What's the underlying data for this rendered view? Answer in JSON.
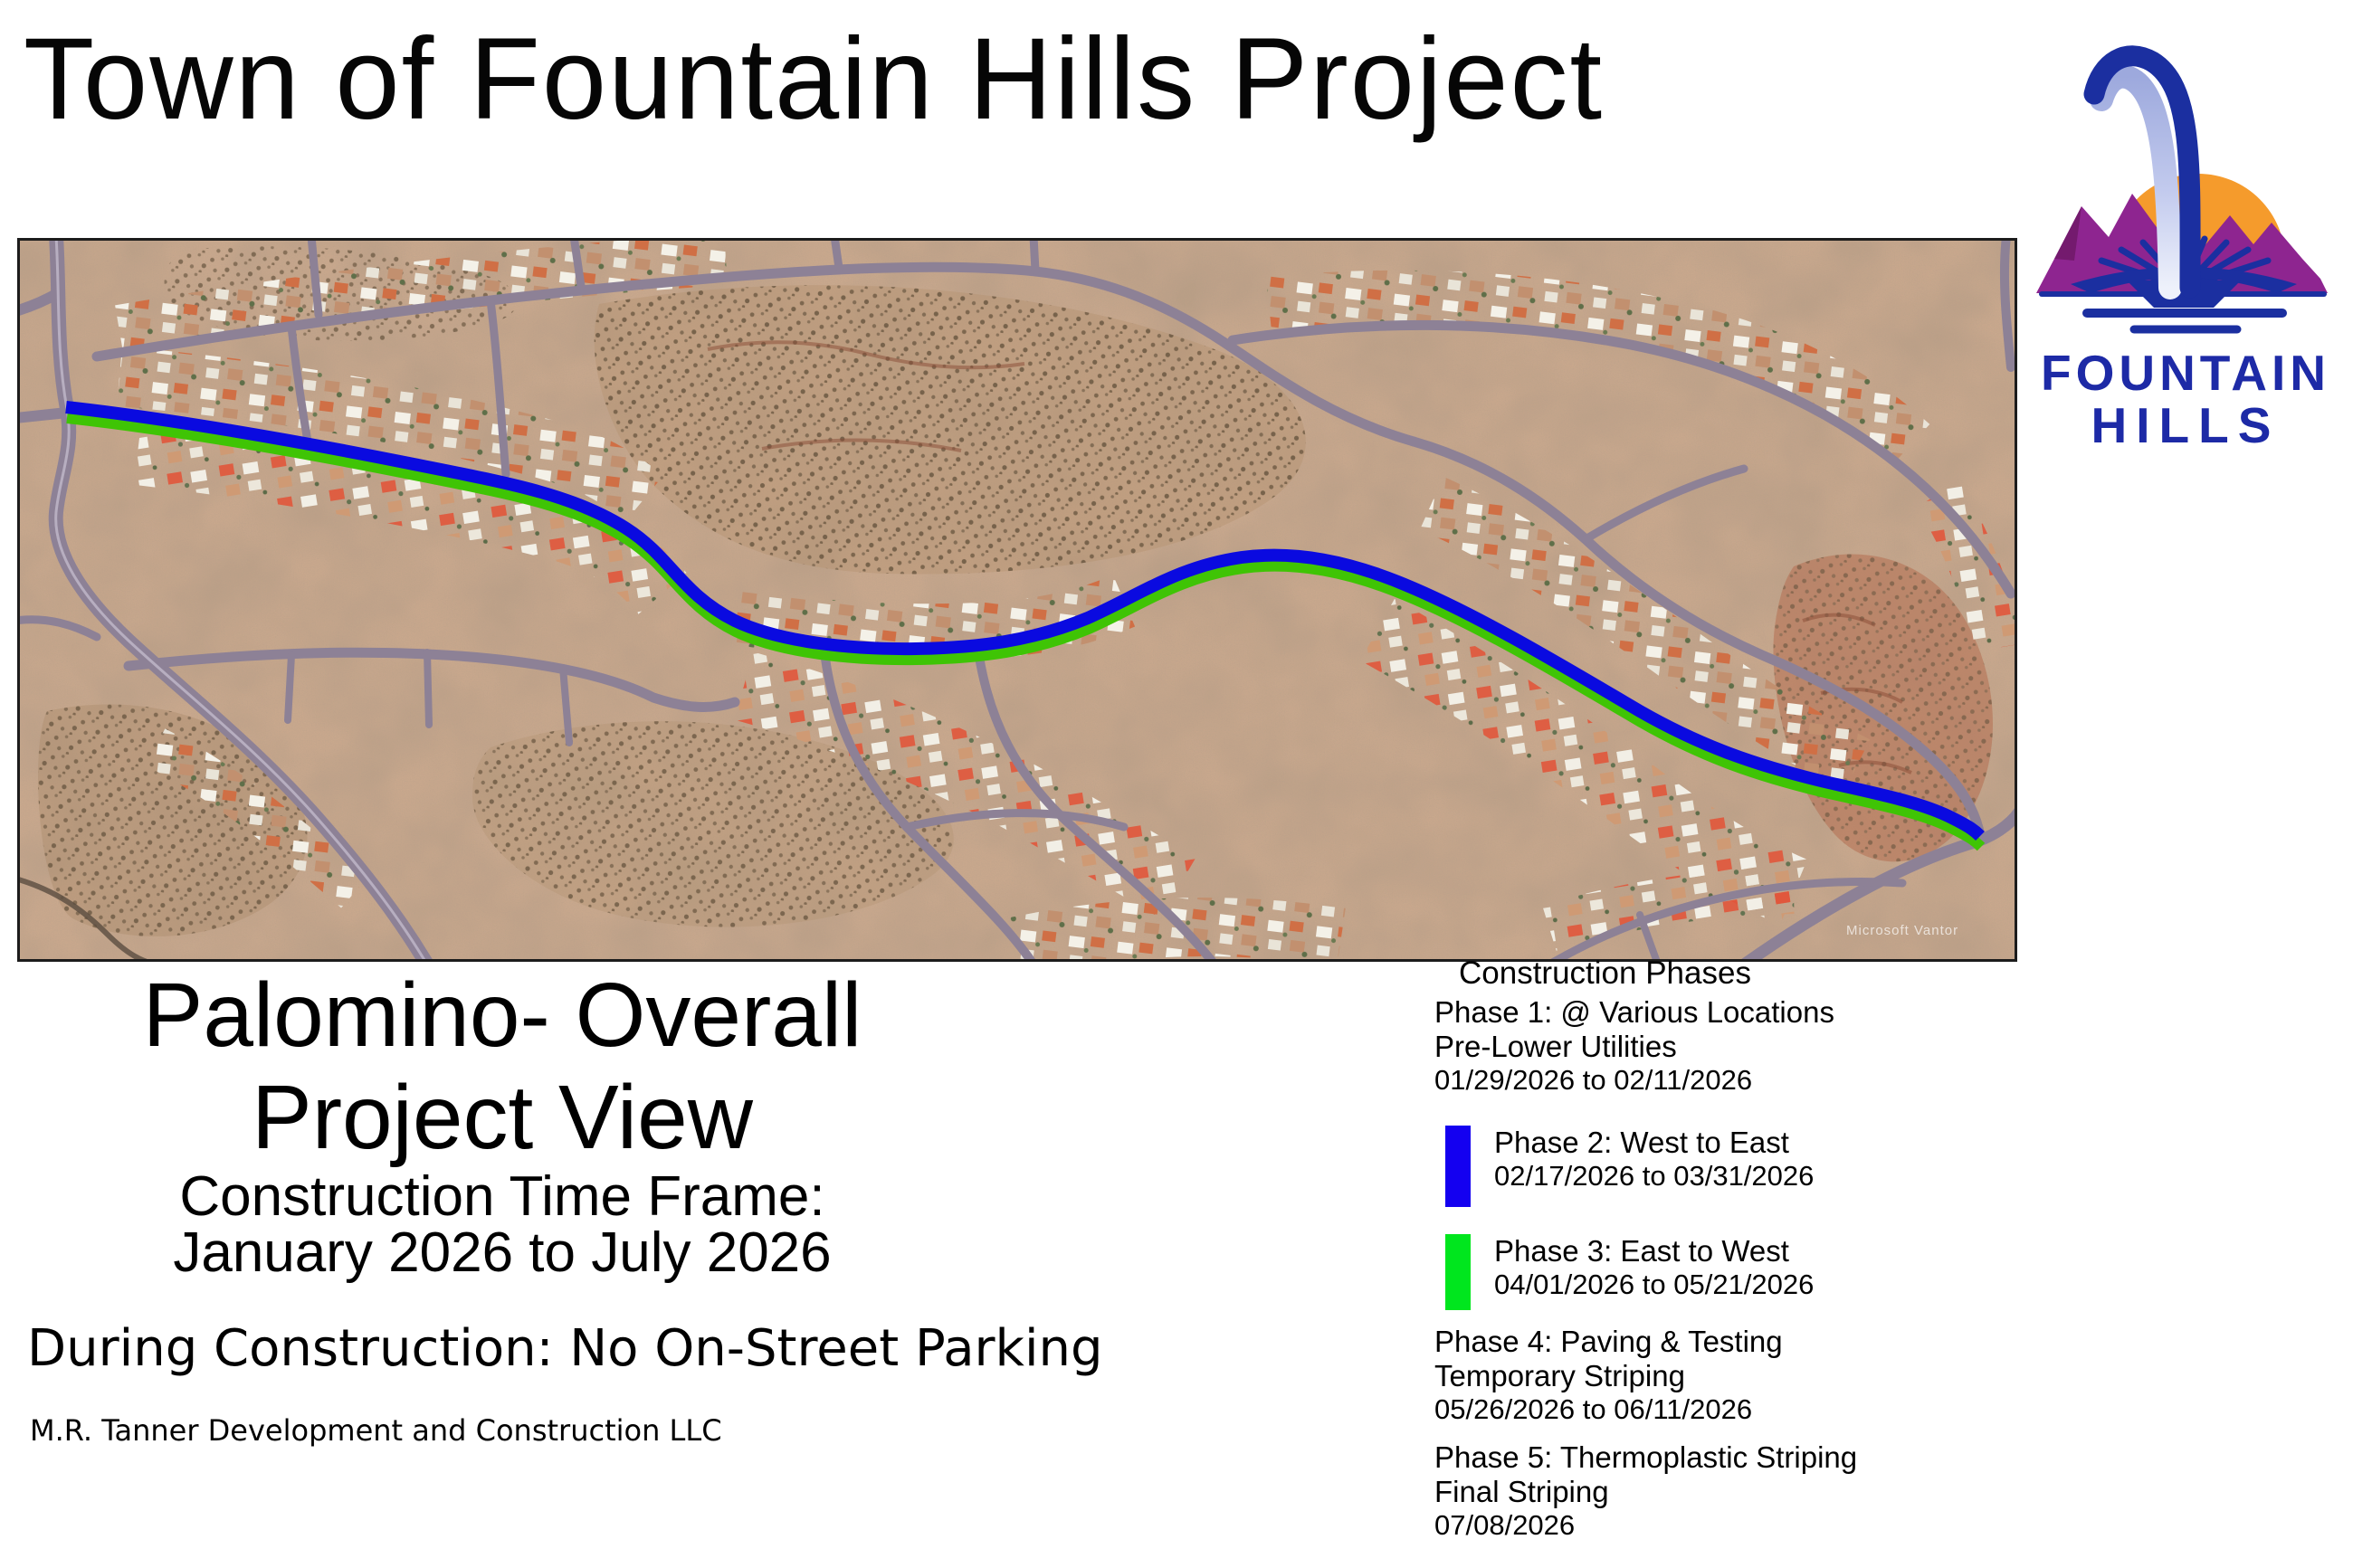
{
  "header": {
    "title": "Town of Fountain Hills Project"
  },
  "logo": {
    "line1": "FOUNTAIN",
    "line2": "HILLS",
    "text_color": "#1D2AA6",
    "arc_blue": "#1B2FA0",
    "spray_light": "#AEB8E6",
    "sun_orange": "#F59B2C",
    "mountain_purple": "#8E2590"
  },
  "map": {
    "watermark": "Microsoft  Vantor",
    "route": {
      "phase2_color": "#0A0AE0",
      "phase3_color": "#3FC405"
    }
  },
  "left_panel": {
    "title_line1": "Palomino- Overall",
    "title_line2": "Project View",
    "subtitle_line1": "Construction Time Frame:",
    "subtitle_line2": "January 2026 to July 2026",
    "notice": "During Construction: No On-Street Parking",
    "contractor": "M.R. Tanner Development and Construction LLC"
  },
  "legend": {
    "title": "Construction Phases",
    "phases": [
      {
        "name": "Phase 1: @ Various Locations",
        "detail": "Pre-Lower Utilities",
        "dates": "01/29/2026 to 02/11/2026",
        "swatch_color": null
      },
      {
        "name": "Phase 2: West to East",
        "detail": null,
        "dates": "02/17/2026 to 03/31/2026",
        "swatch_color": "#1400F0"
      },
      {
        "name": "Phase 3: East to West",
        "detail": null,
        "dates": "04/01/2026 to 05/21/2026",
        "swatch_color": "#00E61E"
      },
      {
        "name": "Phase 4: Paving & Testing",
        "detail": "Temporary Striping",
        "dates": "05/26/2026 to 06/11/2026",
        "swatch_color": null
      },
      {
        "name": "Phase 5: Thermoplastic Striping",
        "detail": "Final Striping",
        "dates": "07/08/2026",
        "swatch_color": null
      }
    ]
  }
}
